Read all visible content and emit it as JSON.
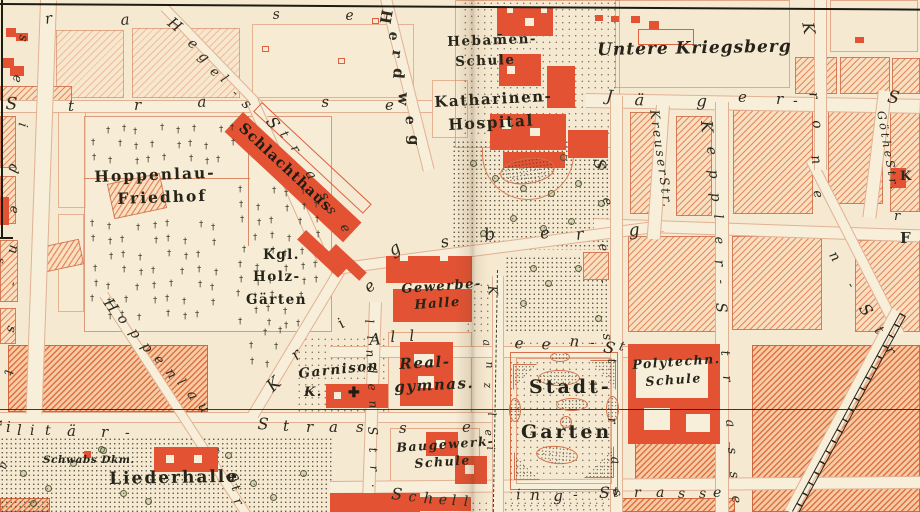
{
  "map": {
    "title": "Stuttgart city map section (Hoppenlau / Stadtgarten district)",
    "colors": {
      "paper": "#f5e9d1",
      "hatch": "#e06c40",
      "building_red": "#e25233",
      "ink": "#29271c",
      "street_edge": "#cc744e",
      "label_ink": "#262419"
    },
    "symbols": {
      "grave_cross": "†",
      "garnison_cross": "✚"
    },
    "labels": {
      "hebamen1": "Hebam̄en-",
      "hebamen2": "Schule",
      "untere_kriegsberg": "Untere Kriegsberg",
      "katharinen1": "Katharinen-",
      "katharinen2": "Hospital",
      "hoppenlau1": "Hoppenlau-",
      "hoppenlau2": "Friedhof",
      "kgl1": "Kgl.",
      "kgl2": "Holz-",
      "kgl3": "Gärten",
      "schlachthaus": "Schlachthaus",
      "gewerbe1": "Gewerbe-",
      "gewerbe2": "Halle",
      "real1": "Real-",
      "real2": "gymnas.",
      "garnison1": "Garnison",
      "garnison2": "K.",
      "stadt1": "Stadt-",
      "stadt2": "Garten",
      "poly1": "Polytechn.",
      "poly2": "Schule",
      "baugewerk1": "Baugewerk-",
      "baugewerk2": "Schule",
      "liederhalle": "Liederhalle",
      "schwabs": "Schwabs Dkm."
    },
    "street_words": [
      {
        "t": "KreuserStr.",
        "x": 660,
        "y": 109,
        "r": 82,
        "s": 12.5,
        "ls": 2.5
      },
      {
        "t": "GötheStr.",
        "x": 886,
        "y": 110,
        "r": 80,
        "s": 11.5,
        "ls": 3
      }
    ],
    "street_letters": [
      {
        "t": "r",
        "x": 44,
        "y": 12,
        "r": -8,
        "s": 15
      },
      {
        "t": "a",
        "x": 120,
        "y": 13,
        "r": -5,
        "s": 15
      },
      {
        "t": "s",
        "x": 272,
        "y": 8,
        "r": -5,
        "s": 14
      },
      {
        "t": "e",
        "x": 345,
        "y": 9,
        "r": -3,
        "s": 14
      },
      {
        "t": "s",
        "x": 30,
        "y": 36,
        "r": 100,
        "s": 13
      },
      {
        "t": "e",
        "x": 24,
        "y": 76,
        "r": 100,
        "s": 13
      },
      {
        "t": "i",
        "x": 29,
        "y": 124,
        "r": 100,
        "s": 13
      },
      {
        "t": "d",
        "x": 21,
        "y": 166,
        "r": 105,
        "s": 14
      },
      {
        "t": "e",
        "x": 21,
        "y": 207,
        "r": 100,
        "s": 13
      },
      {
        "t": "n",
        "x": 21,
        "y": 246,
        "r": 100,
        "s": 14
      },
      {
        "t": "s",
        "x": 7,
        "y": 259,
        "r": 100,
        "s": 11
      },
      {
        "t": "-",
        "x": 20,
        "y": 283,
        "r": 100,
        "s": 13
      },
      {
        "t": "s",
        "x": 18,
        "y": 327,
        "r": 100,
        "s": 13
      },
      {
        "t": "t",
        "x": 15,
        "y": 371,
        "r": 100,
        "s": 13
      },
      {
        "t": "r",
        "x": 6,
        "y": 420,
        "r": 100,
        "s": 12
      },
      {
        "t": "a",
        "x": 11,
        "y": 464,
        "r": 105,
        "s": 12
      },
      {
        "t": "S",
        "x": 6,
        "y": 96,
        "r": 3,
        "s": 17
      },
      {
        "t": "t",
        "x": 68,
        "y": 99,
        "r": 0,
        "s": 15
      },
      {
        "t": "r",
        "x": 134,
        "y": 98,
        "r": 0,
        "s": 15
      },
      {
        "t": "a",
        "x": 197,
        "y": 95,
        "r": -3,
        "s": 15
      },
      {
        "t": "s",
        "x": 321,
        "y": 95,
        "r": -3,
        "s": 15
      },
      {
        "t": "e",
        "x": 385,
        "y": 98,
        "r": 0,
        "s": 15
      },
      {
        "t": "H",
        "x": 174,
        "y": 15,
        "r": 38,
        "s": 15
      },
      {
        "t": "e",
        "x": 194,
        "y": 36,
        "r": 40,
        "s": 14
      },
      {
        "t": "g",
        "x": 205,
        "y": 49,
        "r": 42,
        "s": 14
      },
      {
        "t": "e",
        "x": 216,
        "y": 65,
        "r": 42,
        "s": 13
      },
      {
        "t": "l",
        "x": 227,
        "y": 73,
        "r": 44,
        "s": 13
      },
      {
        "t": "-",
        "x": 238,
        "y": 87,
        "r": 44,
        "s": 13
      },
      {
        "t": "s",
        "x": 249,
        "y": 97,
        "r": 46,
        "s": 14
      },
      {
        "t": "S",
        "x": 276,
        "y": 114,
        "r": 55,
        "s": 16
      },
      {
        "t": "t",
        "x": 288,
        "y": 129,
        "r": 58,
        "s": 13
      },
      {
        "t": "r",
        "x": 299,
        "y": 143,
        "r": 60,
        "s": 13
      },
      {
        "t": "a",
        "x": 315,
        "y": 168,
        "r": 62,
        "s": 14
      },
      {
        "t": "s",
        "x": 329,
        "y": 190,
        "r": 64,
        "s": 14
      },
      {
        "t": "s",
        "x": 336,
        "y": 204,
        "r": 64,
        "s": 14
      },
      {
        "t": "e",
        "x": 349,
        "y": 222,
        "r": 64,
        "s": 13
      },
      {
        "t": "H",
        "x": 394,
        "y": 11,
        "r": 100,
        "s": 15,
        "b": 1
      },
      {
        "t": "e",
        "x": 401,
        "y": 33,
        "r": 100,
        "s": 14,
        "b": 1
      },
      {
        "t": "r",
        "x": 404,
        "y": 51,
        "r": 98,
        "s": 14,
        "b": 1
      },
      {
        "t": "d",
        "x": 406,
        "y": 69,
        "r": 96,
        "s": 15,
        "b": 1
      },
      {
        "t": "w",
        "x": 411,
        "y": 93,
        "r": 94,
        "s": 15,
        "b": 1
      },
      {
        "t": "e",
        "x": 417,
        "y": 116,
        "r": 92,
        "s": 14,
        "b": 1
      },
      {
        "t": "g",
        "x": 421,
        "y": 135,
        "r": 90,
        "s": 15,
        "b": 1
      },
      {
        "t": "J",
        "x": 607,
        "y": 88,
        "r": 5,
        "s": 16
      },
      {
        "t": "ä",
        "x": 635,
        "y": 92,
        "r": 3,
        "s": 16
      },
      {
        "t": "g",
        "x": 697,
        "y": 93,
        "r": 3,
        "s": 16
      },
      {
        "t": "e",
        "x": 738,
        "y": 90,
        "r": 0,
        "s": 15
      },
      {
        "t": "r",
        "x": 776,
        "y": 92,
        "r": 0,
        "s": 15
      },
      {
        "t": "-",
        "x": 793,
        "y": 94,
        "r": 0,
        "s": 14
      },
      {
        "t": "S",
        "x": 889,
        "y": 89,
        "r": 10,
        "s": 17
      },
      {
        "t": "K",
        "x": 714,
        "y": 120,
        "r": 85,
        "s": 16
      },
      {
        "t": "e",
        "x": 718,
        "y": 146,
        "r": 85,
        "s": 14
      },
      {
        "t": "p",
        "x": 720,
        "y": 169,
        "r": 85,
        "s": 14
      },
      {
        "t": "p",
        "x": 722,
        "y": 192,
        "r": 85,
        "s": 14
      },
      {
        "t": "l",
        "x": 724,
        "y": 214,
        "r": 85,
        "s": 13
      },
      {
        "t": "e",
        "x": 725,
        "y": 236,
        "r": 85,
        "s": 13
      },
      {
        "t": "r",
        "x": 726,
        "y": 259,
        "r": 85,
        "s": 14
      },
      {
        "t": "-",
        "x": 727,
        "y": 279,
        "r": 85,
        "s": 13
      },
      {
        "t": "S",
        "x": 728,
        "y": 302,
        "r": 85,
        "s": 15
      },
      {
        "t": "t",
        "x": 731,
        "y": 350,
        "r": 85,
        "s": 13
      },
      {
        "t": "r",
        "x": 733,
        "y": 375,
        "r": 85,
        "s": 13
      },
      {
        "t": "a",
        "x": 736,
        "y": 419,
        "r": 85,
        "s": 13
      },
      {
        "t": "s",
        "x": 738,
        "y": 447,
        "r": 85,
        "s": 13
      },
      {
        "t": "s",
        "x": 740,
        "y": 471,
        "r": 85,
        "s": 13
      },
      {
        "t": "e",
        "x": 742,
        "y": 495,
        "r": 85,
        "s": 13
      },
      {
        "t": "S",
        "x": 607,
        "y": 158,
        "r": 85,
        "s": 16
      },
      {
        "t": "e",
        "x": 613,
        "y": 197,
        "r": 85,
        "s": 13
      },
      {
        "t": "e",
        "x": 609,
        "y": 243,
        "r": 85,
        "s": 13
      },
      {
        "t": "-",
        "x": 609,
        "y": 279,
        "r": 85,
        "s": 12
      },
      {
        "t": "s",
        "x": 613,
        "y": 333,
        "r": 85,
        "s": 13
      },
      {
        "t": "t",
        "x": 618,
        "y": 358,
        "r": 85,
        "s": 12
      },
      {
        "t": "r",
        "x": 618,
        "y": 417,
        "r": 85,
        "s": 13
      },
      {
        "t": "a",
        "x": 621,
        "y": 456,
        "r": 85,
        "s": 13
      },
      {
        "t": "s",
        "x": 623,
        "y": 489,
        "r": 85,
        "s": 13
      },
      {
        "t": "K",
        "x": 815,
        "y": 21,
        "r": 80,
        "s": 16
      },
      {
        "t": "r",
        "x": 820,
        "y": 91,
        "r": 80,
        "s": 14
      },
      {
        "t": "o",
        "x": 823,
        "y": 119,
        "r": 80,
        "s": 14
      },
      {
        "t": "n",
        "x": 822,
        "y": 154,
        "r": 80,
        "s": 14
      },
      {
        "t": "e",
        "x": 823,
        "y": 189,
        "r": 78,
        "s": 13
      },
      {
        "t": "n",
        "x": 838,
        "y": 249,
        "r": 58,
        "s": 14
      },
      {
        "t": "-",
        "x": 855,
        "y": 280,
        "r": 58,
        "s": 13
      },
      {
        "t": "S",
        "x": 869,
        "y": 301,
        "r": 55,
        "s": 16
      },
      {
        "t": "t",
        "x": 883,
        "y": 324,
        "r": 55,
        "s": 14
      },
      {
        "t": "r",
        "x": 894,
        "y": 344,
        "r": 55,
        "s": 14
      },
      {
        "t": "K",
        "x": 264,
        "y": 383,
        "r": -42,
        "s": 17
      },
      {
        "t": "r",
        "x": 288,
        "y": 351,
        "r": -40,
        "s": 16
      },
      {
        "t": "i",
        "x": 335,
        "y": 319,
        "r": -36,
        "s": 15
      },
      {
        "t": "e",
        "x": 361,
        "y": 283,
        "r": -38,
        "s": 16
      },
      {
        "t": "g",
        "x": 386,
        "y": 245,
        "r": -30,
        "s": 17
      },
      {
        "t": "s",
        "x": 439,
        "y": 235,
        "r": -12,
        "s": 16
      },
      {
        "t": "b",
        "x": 483,
        "y": 228,
        "r": -10,
        "s": 17
      },
      {
        "t": "e",
        "x": 539,
        "y": 226,
        "r": -8,
        "s": 16
      },
      {
        "t": "r",
        "x": 575,
        "y": 227,
        "r": -6,
        "s": 16
      },
      {
        "t": "g",
        "x": 628,
        "y": 223,
        "r": -5,
        "s": 17
      },
      {
        "t": "A",
        "x": 369,
        "y": 332,
        "r": -3,
        "s": 16
      },
      {
        "t": "l",
        "x": 390,
        "y": 330,
        "r": -3,
        "s": 15
      },
      {
        "t": "l",
        "x": 409,
        "y": 329,
        "r": -3,
        "s": 15
      },
      {
        "t": "e",
        "x": 515,
        "y": 336,
        "r": 3,
        "s": 15
      },
      {
        "t": "e",
        "x": 542,
        "y": 337,
        "r": 3,
        "s": 15
      },
      {
        "t": "n",
        "x": 570,
        "y": 334,
        "r": 3,
        "s": 15
      },
      {
        "t": "-",
        "x": 590,
        "y": 336,
        "r": 0,
        "s": 14
      },
      {
        "t": "S",
        "x": 606,
        "y": 339,
        "r": 15,
        "s": 16
      },
      {
        "t": "t",
        "x": 621,
        "y": 340,
        "r": 15,
        "s": 13
      },
      {
        "t": "K",
        "x": 498,
        "y": 285,
        "r": 85,
        "s": 13
      },
      {
        "t": "a",
        "x": 492,
        "y": 339,
        "r": 85,
        "s": 11
      },
      {
        "t": "n",
        "x": 495,
        "y": 361,
        "r": 85,
        "s": 11
      },
      {
        "t": "z",
        "x": 493,
        "y": 382,
        "r": 85,
        "s": 11
      },
      {
        "t": "l",
        "x": 497,
        "y": 412,
        "r": 85,
        "s": 11
      },
      {
        "t": "e",
        "x": 494,
        "y": 429,
        "r": 85,
        "s": 11
      },
      {
        "t": "i",
        "x": 496,
        "y": 446,
        "r": 85,
        "s": 11
      },
      {
        "t": "l",
        "x": 375,
        "y": 319,
        "r": 85,
        "s": 12
      },
      {
        "t": "i",
        "x": 377,
        "y": 335,
        "r": 85,
        "s": 12
      },
      {
        "t": "n",
        "x": 376,
        "y": 349,
        "r": 85,
        "s": 12
      },
      {
        "t": "d",
        "x": 377,
        "y": 365,
        "r": 85,
        "s": 13
      },
      {
        "t": "e",
        "x": 378,
        "y": 383,
        "r": 85,
        "s": 12
      },
      {
        "t": "n",
        "x": 379,
        "y": 400,
        "r": 85,
        "s": 12
      },
      {
        "t": "S",
        "x": 378,
        "y": 426,
        "r": 85,
        "s": 13
      },
      {
        "t": "t",
        "x": 379,
        "y": 447,
        "r": 85,
        "s": 12
      },
      {
        "t": "r",
        "x": 380,
        "y": 465,
        "r": 85,
        "s": 12
      },
      {
        "t": ".",
        "x": 382,
        "y": 483,
        "r": 85,
        "s": 12
      },
      {
        "t": "H",
        "x": 113,
        "y": 296,
        "r": 55,
        "s": 15
      },
      {
        "t": "o",
        "x": 126,
        "y": 312,
        "r": 55,
        "s": 14
      },
      {
        "t": "p",
        "x": 138,
        "y": 326,
        "r": 55,
        "s": 14
      },
      {
        "t": "p",
        "x": 150,
        "y": 340,
        "r": 55,
        "s": 14
      },
      {
        "t": "e",
        "x": 162,
        "y": 353,
        "r": 55,
        "s": 13
      },
      {
        "t": "n",
        "x": 174,
        "y": 366,
        "r": 55,
        "s": 14
      },
      {
        "t": "l",
        "x": 185,
        "y": 377,
        "r": 55,
        "s": 13
      },
      {
        "t": "a",
        "x": 196,
        "y": 388,
        "r": 58,
        "s": 14
      },
      {
        "t": "u",
        "x": 207,
        "y": 400,
        "r": 58,
        "s": 14
      },
      {
        "t": "-",
        "x": 223,
        "y": 445,
        "r": 60,
        "s": 13
      },
      {
        "t": "S",
        "x": 236,
        "y": 470,
        "r": 62,
        "s": 15
      },
      {
        "t": "t",
        "x": 240,
        "y": 483,
        "r": 62,
        "s": 13
      },
      {
        "t": "r",
        "x": 242,
        "y": 496,
        "r": 62,
        "s": 13
      },
      {
        "t": "i",
        "x": 6,
        "y": 420,
        "r": 0,
        "s": 15
      },
      {
        "t": "l",
        "x": 17,
        "y": 423,
        "r": 0,
        "s": 15
      },
      {
        "t": "i",
        "x": 30,
        "y": 424,
        "r": 0,
        "s": 14
      },
      {
        "t": "t",
        "x": 45,
        "y": 424,
        "r": 0,
        "s": 14
      },
      {
        "t": "ä",
        "x": 67,
        "y": 424,
        "r": 0,
        "s": 15
      },
      {
        "t": "r",
        "x": 101,
        "y": 425,
        "r": 0,
        "s": 15
      },
      {
        "t": "-",
        "x": 125,
        "y": 426,
        "r": 0,
        "s": 14
      },
      {
        "t": "S",
        "x": 258,
        "y": 416,
        "r": 3,
        "s": 16
      },
      {
        "t": "t",
        "x": 283,
        "y": 419,
        "r": 0,
        "s": 15
      },
      {
        "t": "r",
        "x": 306,
        "y": 420,
        "r": 0,
        "s": 15
      },
      {
        "t": "a",
        "x": 329,
        "y": 420,
        "r": 0,
        "s": 15
      },
      {
        "t": "s",
        "x": 356,
        "y": 420,
        "r": 0,
        "s": 15
      },
      {
        "t": "s",
        "x": 399,
        "y": 421,
        "r": 0,
        "s": 15
      },
      {
        "t": "e",
        "x": 462,
        "y": 420,
        "r": 0,
        "s": 15
      },
      {
        "t": "S",
        "x": 392,
        "y": 486,
        "r": 5,
        "s": 16
      },
      {
        "t": "c",
        "x": 409,
        "y": 490,
        "r": 3,
        "s": 14
      },
      {
        "t": "h",
        "x": 424,
        "y": 491,
        "r": 3,
        "s": 15
      },
      {
        "t": "e",
        "x": 439,
        "y": 493,
        "r": 2,
        "s": 14
      },
      {
        "t": "l",
        "x": 452,
        "y": 494,
        "r": 2,
        "s": 14
      },
      {
        "t": "l",
        "x": 464,
        "y": 495,
        "r": 2,
        "s": 14
      },
      {
        "t": "i",
        "x": 516,
        "y": 488,
        "r": -2,
        "s": 14
      },
      {
        "t": "n",
        "x": 530,
        "y": 488,
        "r": -2,
        "s": 15
      },
      {
        "t": "g",
        "x": 553,
        "y": 489,
        "r": -2,
        "s": 15
      },
      {
        "t": "-",
        "x": 573,
        "y": 488,
        "r": 0,
        "s": 14
      },
      {
        "t": "S",
        "x": 599,
        "y": 485,
        "r": 0,
        "s": 16
      },
      {
        "t": "t",
        "x": 613,
        "y": 486,
        "r": 0,
        "s": 14
      },
      {
        "t": "r",
        "x": 634,
        "y": 486,
        "r": 0,
        "s": 14
      },
      {
        "t": "a",
        "x": 656,
        "y": 486,
        "r": 0,
        "s": 14
      },
      {
        "t": "s",
        "x": 678,
        "y": 487,
        "r": 0,
        "s": 14
      },
      {
        "t": "s",
        "x": 699,
        "y": 487,
        "r": 0,
        "s": 14
      },
      {
        "t": "e",
        "x": 713,
        "y": 486,
        "r": 0,
        "s": 14
      },
      {
        "t": "K",
        "x": 900,
        "y": 170,
        "r": 0,
        "s": 13,
        "b": 1
      },
      {
        "t": "r",
        "x": 894,
        "y": 210,
        "r": 0,
        "s": 13
      },
      {
        "t": "F",
        "x": 900,
        "y": 231,
        "r": 0,
        "s": 15,
        "b": 1
      }
    ]
  }
}
